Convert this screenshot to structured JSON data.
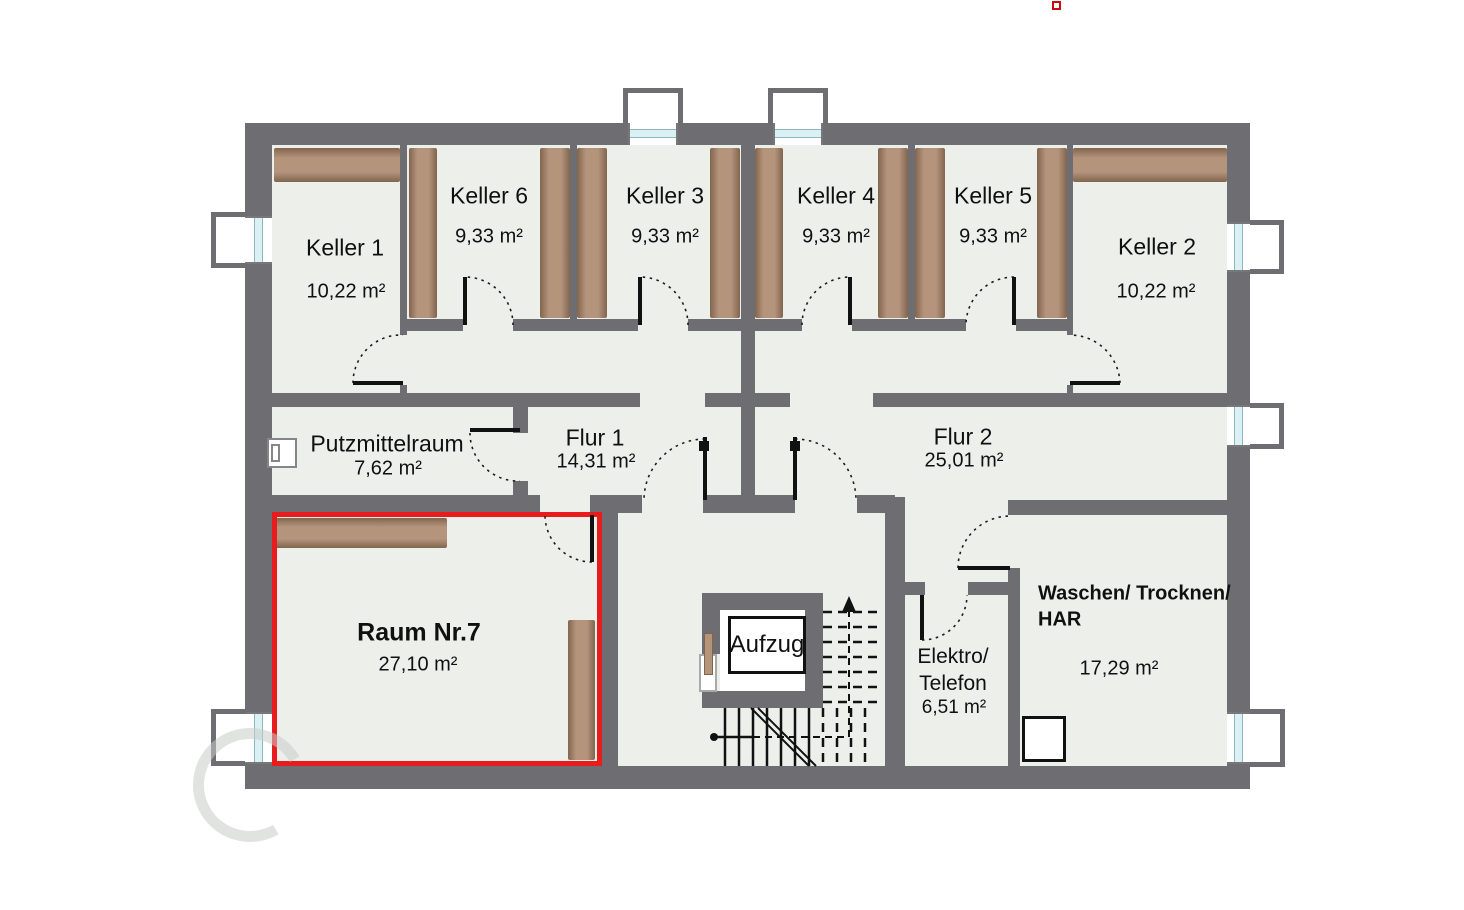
{
  "rooms": {
    "keller1": {
      "name": "Keller 1",
      "area": "10,22 m²"
    },
    "keller6": {
      "name": "Keller 6",
      "area": "9,33 m²"
    },
    "keller3": {
      "name": "Keller 3",
      "area": "9,33 m²"
    },
    "keller4": {
      "name": "Keller 4",
      "area": "9,33 m²"
    },
    "keller5": {
      "name": "Keller 5",
      "area": "9,33 m²"
    },
    "keller2": {
      "name": "Keller 2",
      "area": "10,22 m²"
    },
    "putzmittelraum": {
      "name": "Putzmittelraum",
      "area": "7,62 m²"
    },
    "flur1": {
      "name": "Flur 1",
      "area": "14,31 m²"
    },
    "flur2": {
      "name": "Flur 2",
      "area": "25,01 m²"
    },
    "raum7": {
      "name": "Raum Nr.7",
      "area": "27,10 m²"
    },
    "aufzug": {
      "name": "Aufzug"
    },
    "elektro": {
      "line1": "Elektro/",
      "line2": "Telefon",
      "area": "6,51 m²"
    },
    "waschen": {
      "line1": "Waschen/ Trocknen/",
      "line2": "HAR",
      "area": "17,29 m²"
    }
  },
  "colors": {
    "wall": "#6d6d72",
    "floor": "#edf0ea",
    "shelf_brown": "#b5947c",
    "highlight_red": "#e81c1c",
    "window_glass": "#d9f1f4"
  }
}
